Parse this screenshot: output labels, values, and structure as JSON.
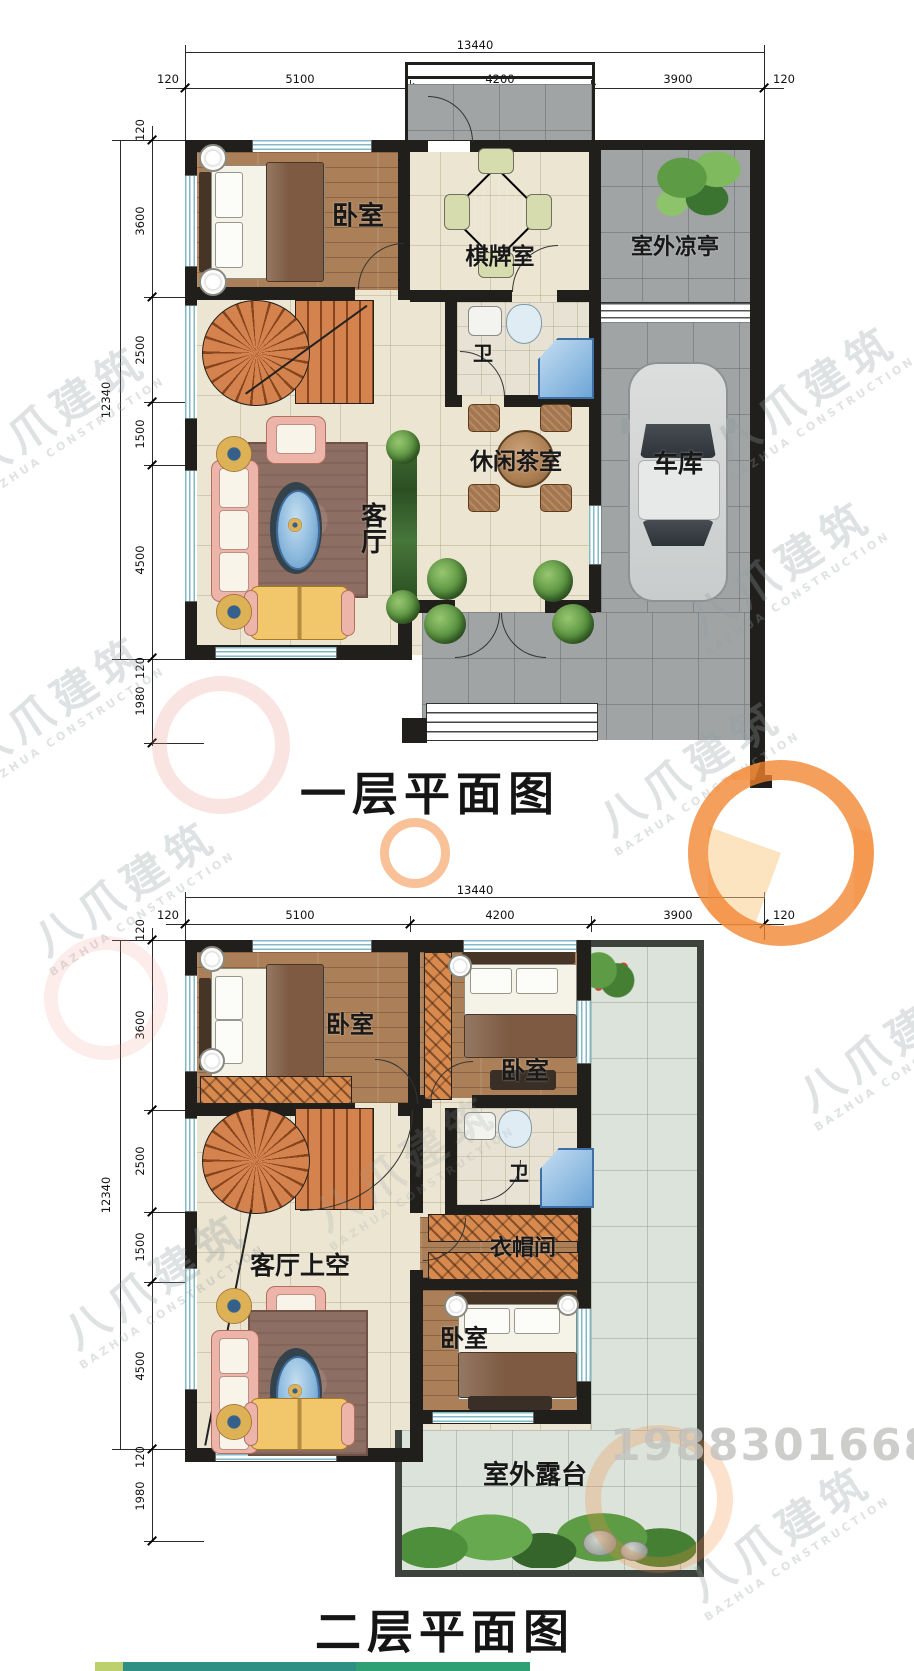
{
  "watermark": {
    "brand": "八爪建筑",
    "brand_en": "BAZHUA CONSTRUCTION",
    "phone": "19883016688"
  },
  "floor1": {
    "title": "一层平面图",
    "dims_top": {
      "total": "13440",
      "seg": [
        "120",
        "5100",
        "4200",
        "3900",
        "120"
      ]
    },
    "dims_left": {
      "total": "12340",
      "seg": [
        "120",
        "3600",
        "2500",
        "1500",
        "4500",
        "120"
      ],
      "below": "1980"
    },
    "rooms": {
      "bedroom": "卧室",
      "game_room": "棋牌室",
      "pavilion": "室外凉亭",
      "bath": "卫",
      "tea_room": "休闲茶室",
      "garage": "车库",
      "living": "客厅"
    }
  },
  "floor2": {
    "title": "二层平面图",
    "dims_top": {
      "total": "13440",
      "seg": [
        "120",
        "5100",
        "4200",
        "3900",
        "120"
      ]
    },
    "dims_left": {
      "total": "12340",
      "seg": [
        "120",
        "3600",
        "2500",
        "1500",
        "4500",
        "120"
      ],
      "below": "1980"
    },
    "rooms": {
      "bedroom_left": "卧室",
      "bedroom_top": "卧室",
      "bedroom_bottom": "卧室",
      "bath": "卫",
      "cloakroom": "衣帽间",
      "living_void": "客厅上空",
      "terrace": "室外露台"
    }
  }
}
